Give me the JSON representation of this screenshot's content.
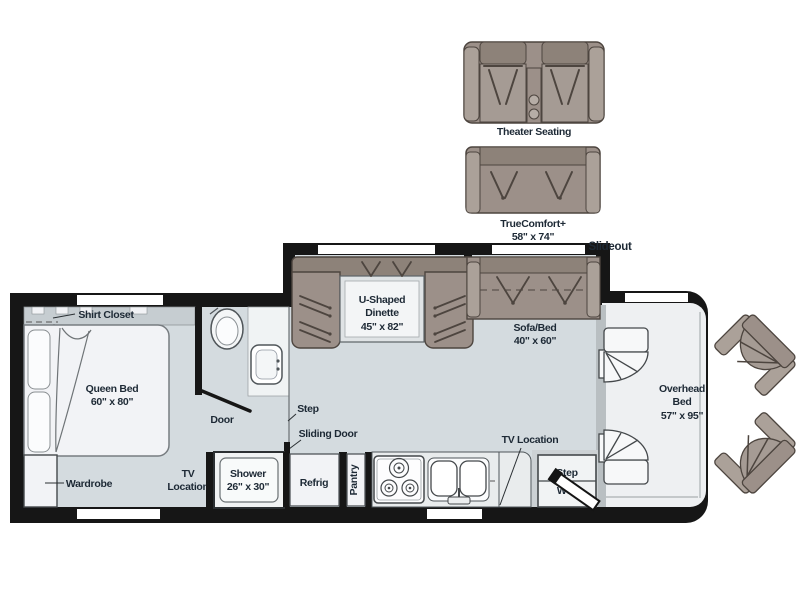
{
  "plan": {
    "options": {
      "theater": {
        "label": "Theater Seating"
      },
      "truecomfort": {
        "label": "TrueComfort+",
        "size": "58\" x 74\""
      }
    },
    "slideout_label": "Slideout",
    "bedroom": {
      "shirt_closet": "Shirt Closet",
      "queen_bed": "Queen Bed",
      "queen_bed_size": "60\" x 80\"",
      "wardrobe": "Wardrobe",
      "tv_line1": "TV",
      "tv_line2": "Location"
    },
    "bath": {
      "door": "Door",
      "shower": "Shower",
      "shower_size": "26\" x 30\""
    },
    "hall": {
      "step": "Step",
      "sliding_door": "Sliding Door"
    },
    "dinette": {
      "line1": "U-Shaped",
      "line2": "Dinette",
      "size": "45\" x 82\""
    },
    "sofa": {
      "label": "Sofa/Bed",
      "size": "40\" x 60\""
    },
    "galley": {
      "refrig": "Refrig",
      "pantry": "Pantry",
      "tv_location": "TV Location"
    },
    "entry": {
      "step_well_line1": "Step",
      "step_well_line2": "Well"
    },
    "cab": {
      "overhead_line1": "Overhead",
      "overhead_line2": "Bed",
      "overhead_size": "57\" x 95\""
    }
  },
  "palette": {
    "wall": "#161616",
    "floor": "#d4dbdf",
    "furniture": "#9c9089",
    "furniture_light": "#aba199",
    "furniture_dark": "#8d8279",
    "fixture_white": "#f2f3f6",
    "text": "#1d2935"
  }
}
